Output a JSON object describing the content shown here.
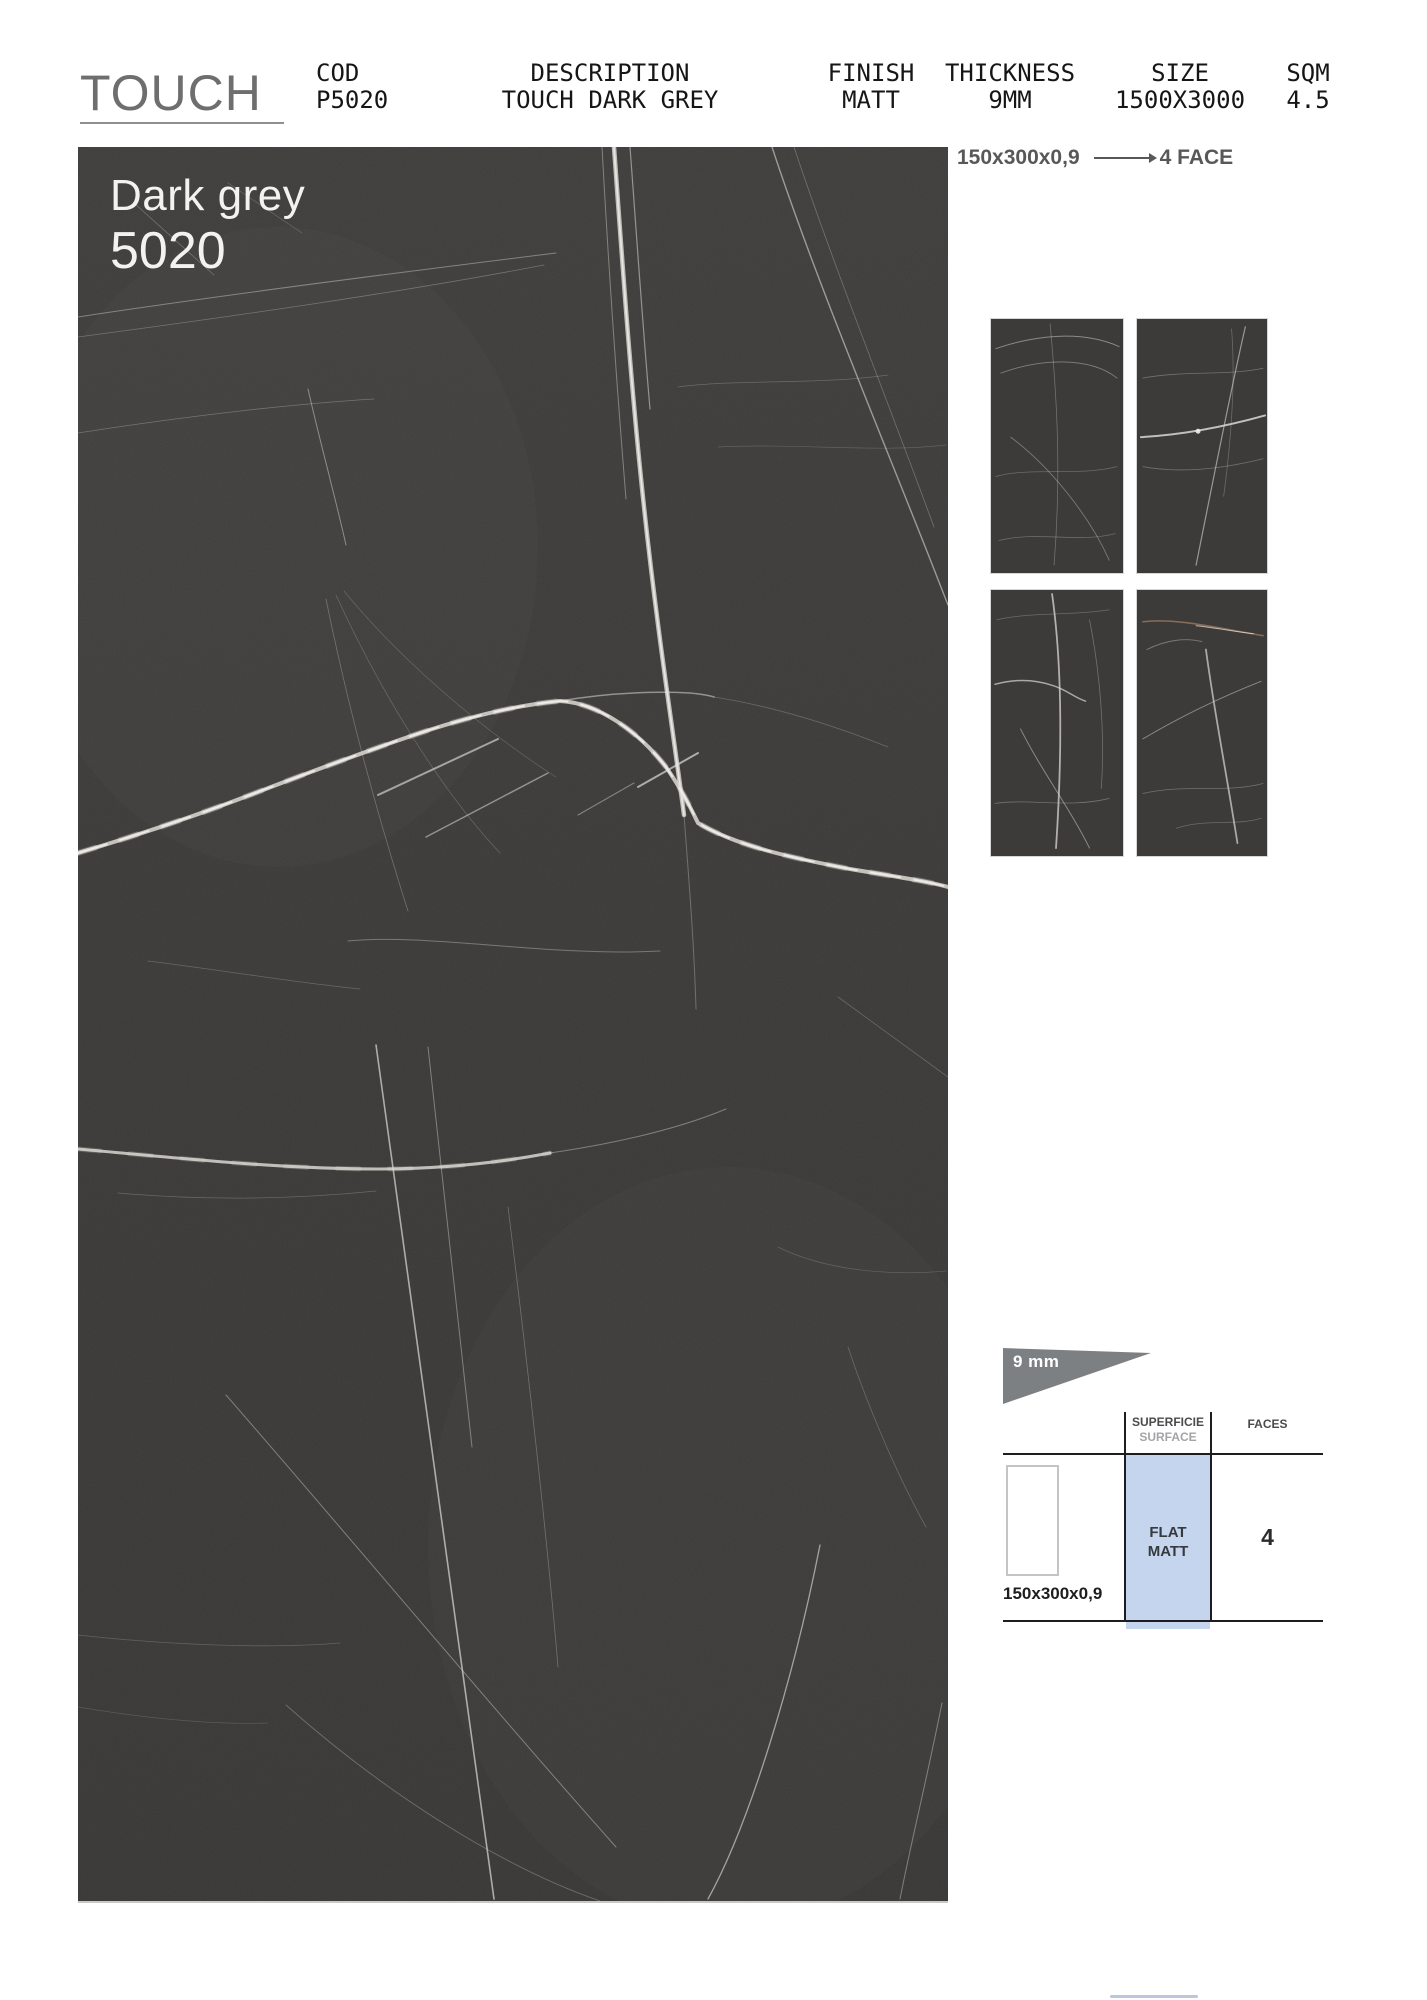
{
  "brand": {
    "logo": "TOUCH"
  },
  "header": {
    "columns": [
      {
        "label": "COD",
        "value": "P5020"
      },
      {
        "label": "DESCRIPTION",
        "value": "TOUCH DARK GREY"
      },
      {
        "label": "FINISH",
        "value": "MATT"
      },
      {
        "label": "THICKNESS",
        "value": "9MM"
      },
      {
        "label": "SIZE",
        "value": "1500X3000"
      },
      {
        "label": "SQM",
        "value": "4.5"
      }
    ]
  },
  "slab": {
    "name": "Dark grey",
    "code": "5020"
  },
  "format_note": {
    "size": "150x300x0,9",
    "faces": "4 FACE"
  },
  "faces_grid": {
    "count": 4
  },
  "spec": {
    "thickness_label": "9 mm",
    "surface_header_primary": "SUPERFICIE",
    "surface_header_secondary": "SURFACE",
    "faces_header": "FACES",
    "tile_size": "150x300x0,9",
    "surface_value_line1": "FLAT",
    "surface_value_line2": "MATT",
    "faces_value": "4"
  },
  "colors": {
    "slab-bg": "#3b3a38",
    "slab-text": "#f3f2ef",
    "vein": "#e8e6e1",
    "logo": "#6e6e6e",
    "note": "#57585a",
    "accent-blue": "#c5d5ee",
    "flag-grey": "#7d8083",
    "rule": "#1d1d1f",
    "muted": "#a2a4a7",
    "footer-line": "#b5c1d9"
  }
}
